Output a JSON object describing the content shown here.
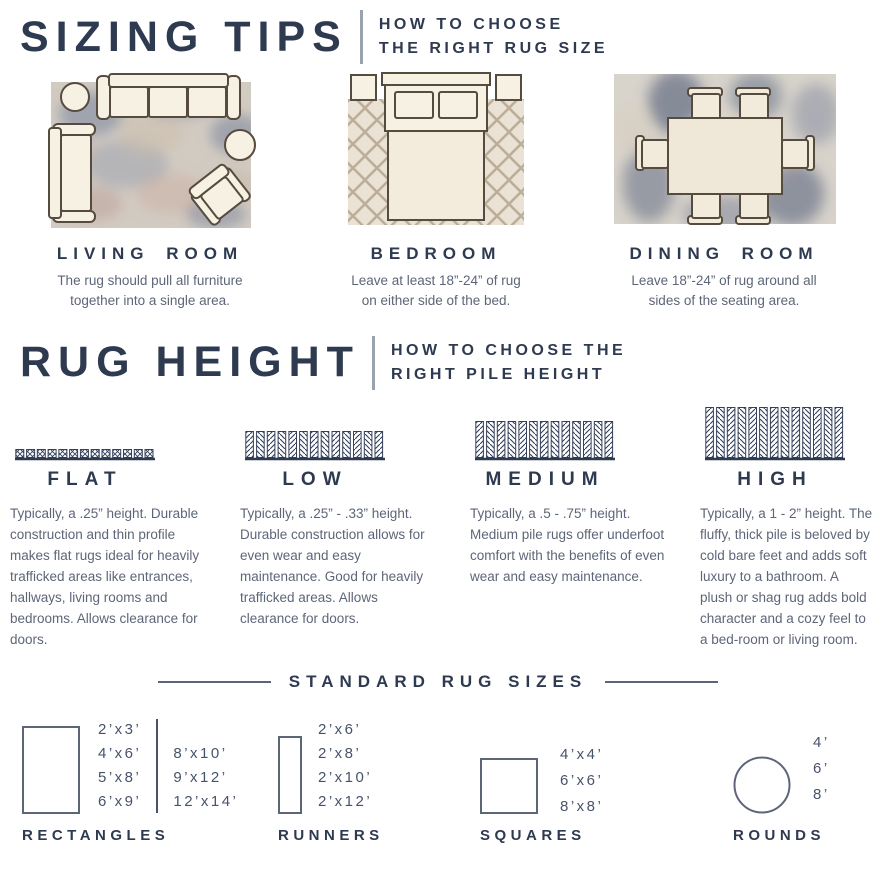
{
  "colors": {
    "heading": "#2e3a50",
    "body": "#5d6678",
    "rule": "#99a2ae"
  },
  "sizing_tips": {
    "title": "SIZING TIPS",
    "subtitle": [
      "HOW TO CHOOSE",
      "THE RIGHT RUG SIZE"
    ],
    "rooms": [
      {
        "name": "LIVING ROOM",
        "description": "The rug should pull all furniture together into a single area."
      },
      {
        "name": "BEDROOM",
        "description": "Leave at least 18”-24” of rug on either side of the bed."
      },
      {
        "name": "DINING ROOM",
        "description": "Leave 18”-24” of rug around all sides of the seating area."
      }
    ]
  },
  "rug_height": {
    "title": "RUG HEIGHT",
    "subtitle": [
      "HOW TO CHOOSE THE",
      "RIGHT PILE HEIGHT"
    ],
    "piles": [
      {
        "name": "FLAT",
        "icon": {
          "type": "squares",
          "height": 8
        },
        "description": "Typically, a .25” height. Durable construction and thin profile makes flat rugs ideal for heavily trafficked areas like entrances, hallways, living rooms and bedrooms. Allows clearance for doors."
      },
      {
        "name": "LOW",
        "icon": {
          "type": "bars",
          "height": 26
        },
        "description": "Typically, a .25” - .33” height. Durable construction allows for even wear and easy maintenance. Good for heavily trafficked areas. Allows clearance for doors."
      },
      {
        "name": "MEDIUM",
        "icon": {
          "type": "bars",
          "height": 36
        },
        "description": "Typically, a .5 - .75” height. Medium pile rugs offer underfoot comfort with the benefits of even wear and easy maintenance."
      },
      {
        "name": "HIGH",
        "icon": {
          "type": "bars",
          "height": 50
        },
        "description": "Typically, a 1 - 2” height. The fluffy, thick pile is beloved by cold bare feet and adds soft luxury to a bathroom. A plush or shag rug adds bold character and a cozy feel to a bed-room or living room."
      }
    ]
  },
  "standard_sizes": {
    "title": "STANDARD RUG SIZES",
    "rectangles": {
      "label": "RECTANGLES",
      "col1": [
        "2’x3’",
        "4’x6’",
        "5’x8’",
        "6’x9’"
      ],
      "col2": [
        "8’x10’",
        "9’x12’",
        "12’x14’"
      ]
    },
    "runners": {
      "label": "RUNNERS",
      "sizes": [
        "2’x6’",
        "2’x8’",
        "2’x10’",
        "2’x12’"
      ]
    },
    "squares": {
      "label": "SQUARES",
      "sizes": [
        "4’x4’",
        "6’x6’",
        "8’x8’"
      ]
    },
    "rounds": {
      "label": "ROUNDS",
      "sizes": [
        "4’",
        "6’",
        "8’"
      ]
    }
  }
}
